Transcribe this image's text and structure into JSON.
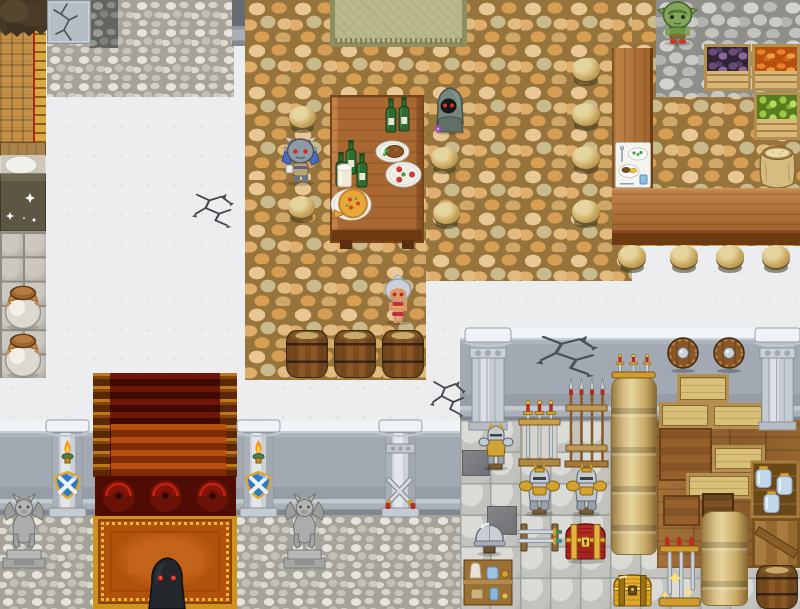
{
  "meta": {
    "app": "rpg-maker-style-game",
    "scene": "tavern-hall-and-armory",
    "viewport": {
      "width": 800,
      "height": 609
    }
  },
  "palette": {
    "white_floor": "#ebedef",
    "tan_cobble": "#d69e55",
    "gray_cobble": "#c6c7c3",
    "wood": "#b1743a",
    "carpet_red": "#6e1608",
    "carpet_orange": "#bc5c12",
    "carpet_gold": "#cf921e",
    "shield_blue": "#2f7ac2",
    "flame_orange": "#ff9420",
    "stone": "#ccd1d8",
    "sack_tan": "#d8c088",
    "eye_red": "#e02418"
  },
  "regions": [
    {
      "name": "pebble-path-topleft",
      "type": "pebble",
      "x": 47,
      "y": 0,
      "w": 187,
      "h": 97,
      "layer": 1
    },
    {
      "name": "pebble-patch-dark",
      "type": "pebble-dark",
      "x": 90,
      "y": 0,
      "w": 28,
      "h": 48,
      "layer": 2
    },
    {
      "name": "cracked-wall-tile",
      "type": "wallcrack",
      "x": 47,
      "y": 0,
      "w": 44,
      "h": 44,
      "layer": 3
    },
    {
      "name": "dark-wall-segment",
      "type": "walldark",
      "x": 232,
      "y": 0,
      "w": 49,
      "h": 46,
      "layer": 4
    },
    {
      "name": "tavern-floor-main",
      "type": "cobtan",
      "x": 245,
      "y": 0,
      "w": 387,
      "h": 281,
      "layer": 5
    },
    {
      "name": "tavern-floor-left",
      "type": "cobtan",
      "x": 245,
      "y": 180,
      "w": 181,
      "h": 200,
      "layer": 5
    },
    {
      "name": "tavern-floor-right",
      "type": "cobtan",
      "x": 632,
      "y": 0,
      "w": 168,
      "h": 246,
      "layer": 5
    },
    {
      "name": "gray-cobble-path",
      "type": "cobgray",
      "x": 656,
      "y": 0,
      "w": 144,
      "h": 97,
      "layer": 6
    },
    {
      "name": "armory-wall",
      "type": "wall",
      "x": 460,
      "y": 328,
      "w": 340,
      "h": 94,
      "layer": 7
    },
    {
      "name": "armory-floor",
      "type": "tiles",
      "x": 460,
      "y": 420,
      "w": 340,
      "h": 189,
      "layer": 8
    },
    {
      "name": "armory-wood-floor",
      "type": "wood",
      "x": 657,
      "y": 420,
      "w": 143,
      "h": 148,
      "layer": 22
    },
    {
      "name": "hall-wall",
      "type": "wall",
      "x": 0,
      "y": 421,
      "w": 460,
      "h": 94,
      "layer": 7
    },
    {
      "name": "hall-floor",
      "type": "pebble",
      "x": 0,
      "y": 515,
      "w": 460,
      "h": 94,
      "layer": 8
    },
    {
      "name": "lattice-wall",
      "type": "lattice",
      "x": 0,
      "y": 28,
      "w": 34,
      "h": 115,
      "layer": 9
    },
    {
      "name": "ladder-trim",
      "type": "ladder",
      "x": 33,
      "y": 28,
      "w": 13,
      "h": 115,
      "layer": 10
    },
    {
      "name": "fur-canopy",
      "type": "fur",
      "x": 0,
      "y": 0,
      "w": 47,
      "h": 38,
      "layer": 11
    },
    {
      "name": "bed",
      "type": "bed",
      "x": 0,
      "y": 142,
      "w": 46,
      "h": 90,
      "layer": 9
    },
    {
      "name": "left-tile-column",
      "type": "tilecol",
      "x": 0,
      "y": 232,
      "w": 46,
      "h": 146,
      "layer": 9
    }
  ],
  "props": [
    {
      "name": "entry-mat",
      "type": "mat",
      "x": 330,
      "y": 0,
      "w": 137,
      "h": 47
    },
    {
      "name": "eggplant-crate",
      "type": "crate-produce",
      "variant": "eggplant",
      "x": 704,
      "y": 44,
      "w": 47,
      "h": 47
    },
    {
      "name": "carrot-crate",
      "type": "crate-produce",
      "variant": "carrot",
      "x": 752,
      "y": 44,
      "w": 48,
      "h": 47
    },
    {
      "name": "apple-crate",
      "type": "crate-produce",
      "variant": "apple",
      "x": 754,
      "y": 92,
      "w": 46,
      "h": 48
    },
    {
      "name": "grain-sack",
      "type": "sackOpen",
      "x": 755,
      "y": 140,
      "w": 45,
      "h": 50
    },
    {
      "name": "bar-counter-vertical",
      "type": "counterV",
      "x": 612,
      "y": 48,
      "w": 41,
      "h": 140
    },
    {
      "name": "bar-counter-horizontal",
      "type": "counterH",
      "x": 612,
      "y": 188,
      "w": 188,
      "h": 57
    },
    {
      "name": "menu-card",
      "type": "menuCard",
      "x": 615,
      "y": 142,
      "w": 36,
      "h": 46,
      "layer": 400
    },
    {
      "name": "dining-table",
      "type": "table",
      "x": 330,
      "y": 95,
      "w": 94,
      "h": 148
    },
    {
      "name": "wine-bottle-pair",
      "type": "bottles2",
      "x": 385,
      "y": 97,
      "w": 26,
      "h": 36,
      "layer": 400
    },
    {
      "name": "wine-bottle-trio",
      "type": "bottles3",
      "x": 336,
      "y": 140,
      "w": 34,
      "h": 47,
      "layer": 400
    },
    {
      "name": "milk-glass",
      "type": "glass",
      "x": 336,
      "y": 163,
      "w": 17,
      "h": 25,
      "layer": 401
    },
    {
      "name": "meat-plate",
      "type": "plate",
      "variant": "meat",
      "x": 375,
      "y": 140,
      "w": 35,
      "h": 23,
      "layer": 400
    },
    {
      "name": "caprese-plate",
      "type": "plate",
      "variant": "caprese",
      "x": 385,
      "y": 161,
      "w": 37,
      "h": 27,
      "layer": 400
    },
    {
      "name": "pizza-plate",
      "type": "plate",
      "variant": "pizza",
      "x": 330,
      "y": 188,
      "w": 42,
      "h": 33,
      "layer": 400
    },
    {
      "name": "stool-table-nw",
      "type": "stool",
      "x": 288,
      "y": 106,
      "w": 29,
      "h": 27
    },
    {
      "name": "stool-table-sw",
      "type": "stool",
      "x": 287,
      "y": 196,
      "w": 29,
      "h": 27
    },
    {
      "name": "stool-table-ne",
      "type": "stool",
      "x": 430,
      "y": 147,
      "w": 29,
      "h": 27
    },
    {
      "name": "stool-table-se",
      "type": "stool",
      "x": 432,
      "y": 202,
      "w": 29,
      "h": 27
    },
    {
      "name": "stool-bar-1",
      "type": "stool",
      "x": 571,
      "y": 58,
      "w": 30,
      "h": 28
    },
    {
      "name": "stool-bar-2",
      "type": "stool",
      "x": 571,
      "y": 103,
      "w": 30,
      "h": 28
    },
    {
      "name": "stool-bar-3",
      "type": "stool",
      "x": 571,
      "y": 146,
      "w": 30,
      "h": 28
    },
    {
      "name": "stool-bar-4",
      "type": "stool",
      "x": 571,
      "y": 200,
      "w": 30,
      "h": 28
    },
    {
      "name": "stool-counter-1",
      "type": "stool",
      "x": 617,
      "y": 245,
      "w": 30,
      "h": 28
    },
    {
      "name": "stool-counter-2",
      "type": "stool",
      "x": 669,
      "y": 245,
      "w": 30,
      "h": 28
    },
    {
      "name": "stool-counter-3",
      "type": "stool",
      "x": 715,
      "y": 245,
      "w": 30,
      "h": 28
    },
    {
      "name": "stool-counter-4",
      "type": "stool",
      "x": 761,
      "y": 245,
      "w": 30,
      "h": 28
    },
    {
      "name": "cellar-barrel-1",
      "type": "barrel",
      "x": 286,
      "y": 330,
      "w": 42,
      "h": 48
    },
    {
      "name": "cellar-barrel-2",
      "type": "barrel",
      "x": 334,
      "y": 330,
      "w": 42,
      "h": 48
    },
    {
      "name": "cellar-barrel-3",
      "type": "barrel",
      "x": 382,
      "y": 330,
      "w": 42,
      "h": 48
    },
    {
      "name": "staircase-carpet",
      "type": "stairs",
      "x": 93,
      "y": 373,
      "w": 144,
      "h": 104,
      "layer": 30
    },
    {
      "name": "staircase-light",
      "type": "stairslight",
      "x": 111,
      "y": 424,
      "w": 115,
      "h": 53,
      "layer": 31
    },
    {
      "name": "carpet-swirl-row",
      "type": "swirls",
      "x": 95,
      "y": 476,
      "w": 141,
      "h": 40,
      "layer": 32
    },
    {
      "name": "carpet-landing",
      "type": "landing",
      "x": 93,
      "y": 514,
      "w": 144,
      "h": 95,
      "layer": 30
    },
    {
      "name": "hall-pillar-torch-left",
      "type": "pillarTorch",
      "x": 44,
      "y": 420,
      "w": 47,
      "h": 97
    },
    {
      "name": "hall-pillar-torch-right",
      "type": "pillarTorch",
      "x": 235,
      "y": 420,
      "w": 47,
      "h": 97
    },
    {
      "name": "hall-pillar-crossed-swords",
      "type": "pillarSword",
      "x": 377,
      "y": 420,
      "w": 47,
      "h": 97
    },
    {
      "name": "gargoyle-statue-left",
      "type": "gargoyle",
      "x": 0,
      "y": 486,
      "w": 48,
      "h": 85
    },
    {
      "name": "gargoyle-statue-right",
      "type": "gargoyle",
      "x": 281,
      "y": 486,
      "w": 47,
      "h": 85
    },
    {
      "name": "armory-pillar-left",
      "type": "pillarStone",
      "x": 465,
      "y": 328,
      "w": 46,
      "h": 102
    },
    {
      "name": "armory-pillar-right",
      "type": "pillarStone",
      "x": 755,
      "y": 328,
      "w": 45,
      "h": 102
    },
    {
      "name": "wall-shield-left",
      "type": "shieldRound",
      "x": 666,
      "y": 336,
      "w": 34,
      "h": 37
    },
    {
      "name": "wall-shield-right",
      "type": "shieldRound",
      "x": 712,
      "y": 336,
      "w": 34,
      "h": 37
    },
    {
      "name": "wall-sword-display",
      "type": "swordRackWall",
      "x": 611,
      "y": 354,
      "w": 45,
      "h": 27,
      "layer": 700
    },
    {
      "name": "sack-stack-tall",
      "type": "sackcol",
      "x": 611,
      "y": 377,
      "w": 46,
      "h": 178
    },
    {
      "name": "spear-rack",
      "type": "spearRack",
      "x": 563,
      "y": 377,
      "w": 47,
      "h": 91
    },
    {
      "name": "standing-sword-rack",
      "type": "swordRackUp",
      "x": 516,
      "y": 399,
      "w": 47,
      "h": 69
    },
    {
      "name": "armor-statue-small",
      "type": "armorSmall",
      "x": 476,
      "y": 424,
      "w": 40,
      "h": 47
    },
    {
      "name": "crate-stack-top",
      "type": "crate",
      "x": 677,
      "y": 374,
      "w": 52,
      "h": 29
    },
    {
      "name": "crate-stack-left",
      "type": "crate",
      "x": 659,
      "y": 402,
      "w": 52,
      "h": 27
    },
    {
      "name": "crate-stack-right",
      "type": "crate",
      "x": 711,
      "y": 403,
      "w": 54,
      "h": 26
    },
    {
      "name": "crate-brown-large",
      "type": "crate-brown",
      "x": 659,
      "y": 428,
      "w": 53,
      "h": 53
    },
    {
      "name": "crate-right-low",
      "type": "crate",
      "x": 712,
      "y": 445,
      "w": 53,
      "h": 27
    },
    {
      "name": "crate-embedded-1",
      "type": "crate",
      "x": 686,
      "y": 473,
      "w": 66,
      "h": 26
    },
    {
      "name": "crate-embedded-2",
      "type": "crate-brown",
      "x": 663,
      "y": 495,
      "w": 37,
      "h": 31
    },
    {
      "name": "crate-embedded-3",
      "type": "crate-dark",
      "x": 702,
      "y": 493,
      "w": 32,
      "h": 28
    },
    {
      "name": "potion-jar-shelf",
      "type": "jarShelf",
      "x": 751,
      "y": 461,
      "w": 48,
      "h": 57
    },
    {
      "name": "plank-door",
      "type": "door",
      "x": 752,
      "y": 518,
      "w": 48,
      "h": 50,
      "interactable": true
    },
    {
      "name": "armor-suit-left",
      "type": "armorSuit",
      "x": 516,
      "y": 465,
      "w": 47,
      "h": 52
    },
    {
      "name": "armor-suit-right",
      "type": "armorSuit",
      "x": 563,
      "y": 465,
      "w": 47,
      "h": 52
    },
    {
      "name": "dark-tile-1",
      "type": "tile-dark",
      "x": 487,
      "y": 506,
      "w": 30,
      "h": 29,
      "layer": 25
    },
    {
      "name": "dark-tile-2",
      "type": "tile-dark",
      "x": 462,
      "y": 450,
      "w": 28,
      "h": 26,
      "layer": 25
    },
    {
      "name": "helmet-display",
      "type": "helmet",
      "x": 472,
      "y": 515,
      "w": 35,
      "h": 42
    },
    {
      "name": "flat-sword-rack",
      "type": "swordRackFlat",
      "x": 515,
      "y": 518,
      "w": 49,
      "h": 39
    },
    {
      "name": "treasure-chest-red",
      "type": "chestRed",
      "x": 563,
      "y": 520,
      "w": 45,
      "h": 44,
      "interactable": true
    },
    {
      "name": "treasure-chest-gold",
      "type": "chestGold",
      "x": 611,
      "y": 572,
      "w": 43,
      "h": 37,
      "interactable": true
    },
    {
      "name": "candle-sword-stand",
      "type": "swordStand",
      "x": 655,
      "y": 538,
      "w": 49,
      "h": 71
    },
    {
      "name": "sack-stack-short",
      "type": "sackcol",
      "x": 701,
      "y": 511,
      "w": 47,
      "h": 95
    },
    {
      "name": "storage-barrel",
      "type": "barrel",
      "x": 756,
      "y": 565,
      "w": 42,
      "h": 44
    },
    {
      "name": "storage-shelf",
      "type": "shelfItems",
      "x": 463,
      "y": 559,
      "w": 50,
      "h": 47
    },
    {
      "name": "pot-jar-1",
      "type": "jarPot",
      "x": 2,
      "y": 282,
      "w": 42,
      "h": 48
    },
    {
      "name": "pot-jar-2",
      "type": "jarPot",
      "x": 2,
      "y": 330,
      "w": 42,
      "h": 48
    }
  ],
  "decals": [
    {
      "name": "floor-crack-1",
      "type": "crack",
      "variant": "floor",
      "x": 192,
      "y": 189,
      "w": 42,
      "h": 38,
      "layer": 28
    },
    {
      "name": "floor-crack-2",
      "type": "crack",
      "variant": "floor",
      "x": 430,
      "y": 376,
      "w": 36,
      "h": 40,
      "layer": 28
    },
    {
      "name": "armory-wall-crack",
      "type": "crack",
      "variant": "wall",
      "x": 536,
      "y": 330,
      "w": 62,
      "h": 46,
      "layer": 28
    }
  ],
  "characters": [
    {
      "name": "goblin-villager",
      "type": "goblin",
      "x": 659,
      "y": 0,
      "w": 37,
      "h": 46,
      "interactable": true,
      "desc": "green goblin standing on gray cobble path"
    },
    {
      "name": "hooded-wraith",
      "type": "wraith",
      "x": 431,
      "y": 86,
      "w": 38,
      "h": 49,
      "interactable": true,
      "desc": "gray hooded figure with red eyes beside table"
    },
    {
      "name": "blue-imp",
      "type": "imp",
      "x": 281,
      "y": 135,
      "w": 39,
      "h": 51,
      "interactable": true,
      "desc": "blue horned winged imp holding a mug"
    },
    {
      "name": "silver-dancer",
      "type": "dancer",
      "x": 380,
      "y": 274,
      "w": 36,
      "h": 51,
      "interactable": true,
      "desc": "silver-haired tan-skinned dancer"
    },
    {
      "name": "shadow-lurker",
      "type": "shadow",
      "x": 145,
      "y": 555,
      "w": 44,
      "h": 54,
      "interactable": true,
      "desc": "black shadow creature with glowing red eyes on carpet"
    }
  ]
}
